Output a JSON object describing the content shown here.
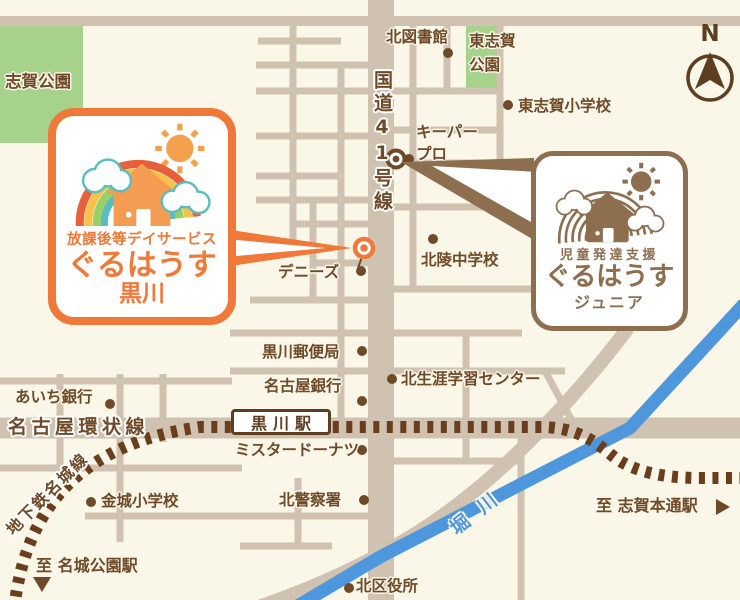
{
  "compass": {
    "label": "N"
  },
  "parks": {
    "shiga": "志賀公園",
    "higashi_shiga_line1": "東志賀",
    "higashi_shiga_line2": "公園"
  },
  "roads": {
    "route41": "国道41号線",
    "kanjo_line": "名古屋環状線",
    "subway_meijo": "地下鉄名城線",
    "hori_river": "堀川"
  },
  "station": {
    "kurokawa": "黒川駅"
  },
  "pois": {
    "kita_library": "北図書館",
    "higashi_shiga_elementary": "東志賀小学校",
    "keeper_pro_line1": "キーパー",
    "keeper_pro_line2": "プロ",
    "hokuryo_junior_high": "北陵中学校",
    "dennys": "デニーズ",
    "kurokawa_post_office": "黒川郵便局",
    "nagoya_bank": "名古屋銀行",
    "kita_lifelong_learning_center": "北生涯学習センター",
    "aichi_bank": "あいち銀行",
    "mister_donut": "ミスタードーナツ",
    "kinjo_elementary": "金城小学校",
    "kita_police": "北警察署",
    "kita_ward_office": "北区役所"
  },
  "directions": {
    "to_meijo_koen": "至 名城公園駅",
    "to_shiga_hondori": "至 志賀本通駅"
  },
  "callout_main": {
    "service": "放課後等デイサービス",
    "name": "ぐるはうす",
    "branch": "黒川"
  },
  "callout_junior": {
    "service": "児童発達支援",
    "name": "ぐるはうす",
    "branch": "ジュニア"
  },
  "colors": {
    "accent_orange": "#f0793a",
    "brand_brown": "#8d6e4f",
    "text_brown": "#6f4a28",
    "park_green": "#a6d28c",
    "river_blue": "#4e97dc",
    "road_taupe": "#d0c2b1",
    "rail_brown": "#6a3e1d",
    "background_cream": "#faf6e8"
  }
}
